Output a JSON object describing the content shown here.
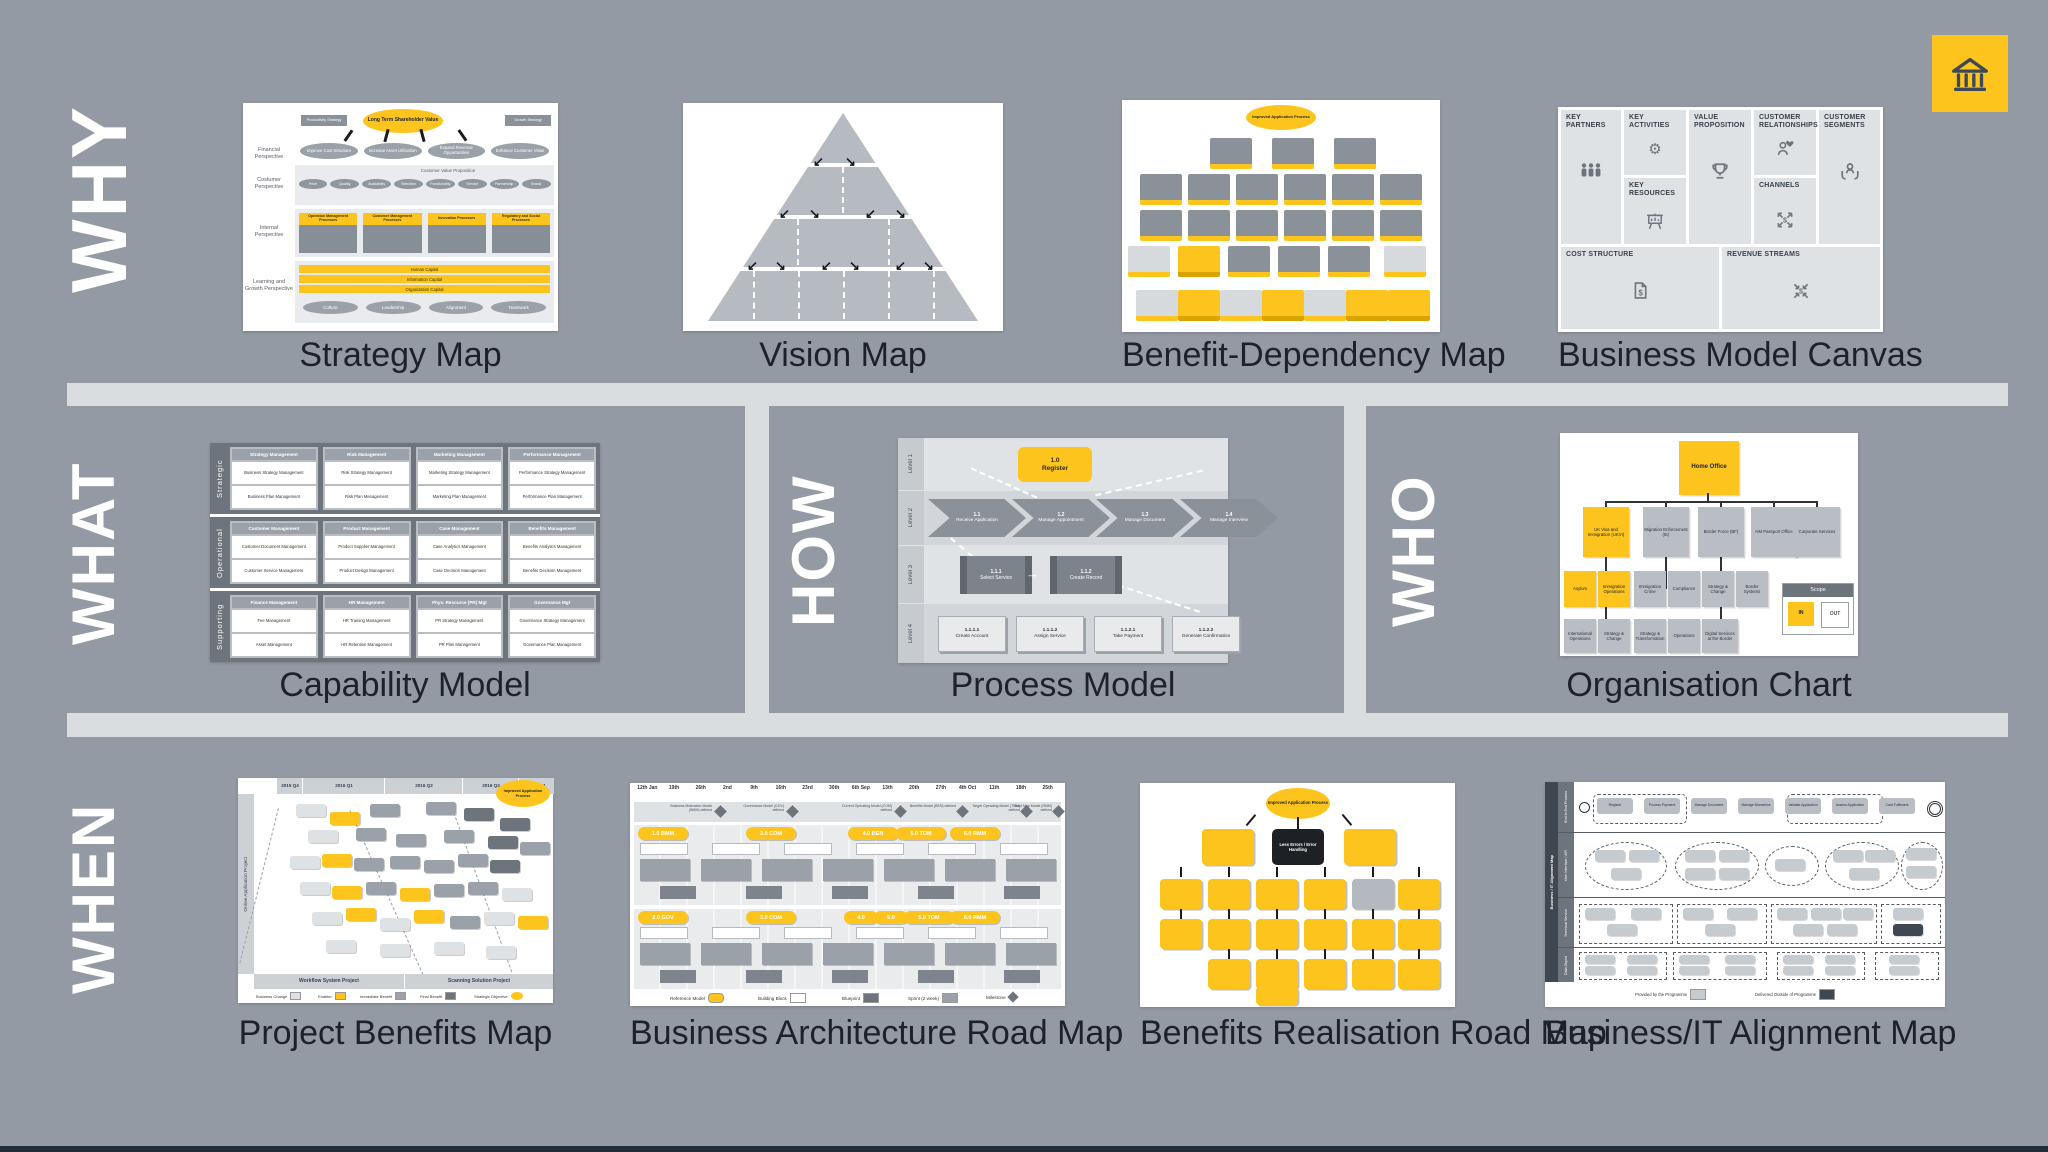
{
  "colors": {
    "background": "#939aa3",
    "divider": "#d9dde0",
    "accent_yellow": "#fcc41d",
    "ink": "#20242c",
    "panel_dark": "#6d747c",
    "footer_navy": "#232c3a"
  },
  "brand": {
    "icon": "bank-icon"
  },
  "why": {
    "label": "WHY",
    "strategy_map": {
      "title": "Strategy Map",
      "objective": "Long Term Shareholder Value",
      "left_tag": "Productivity Strategy",
      "right_tag": "Growth Strategy",
      "perspectives": [
        "Financial Perspective",
        "Costumer Perspective",
        "Internal Perspective",
        "Learning and Growth Perspective"
      ],
      "financial_goals": [
        "Improve Cost Structure",
        "Increase Asset Utilisation",
        "Expand Revenue Opportunities",
        "Enhance Costumer Value"
      ],
      "customer_value_proposition": "Customer Value Proposition",
      "customer_attributes": [
        "Price",
        "Quality",
        "Availability",
        "Selection",
        "Functionality",
        "Service",
        "Partnership",
        "Brand"
      ],
      "internal_processes": [
        "Operation Management Processes",
        "Customer Management Processes",
        "Innovation Processes",
        "Regulatory and Social Processes"
      ],
      "capitals": [
        "Human Capital",
        "Information Capital",
        "Organization Capital"
      ],
      "learning_values": [
        "Culture",
        "Leadership",
        "Alignment",
        "Teamwork"
      ]
    },
    "vision_map": {
      "title": "Vision Map"
    },
    "benefit_dependency_map": {
      "title": "Benefit-Dependency Map",
      "objective": "Improved Application Process"
    },
    "business_model_canvas": {
      "title": "Business Model Canvas",
      "key_partners": "KEY PARTNERS",
      "key_activities": "KEY ACTIVITIES",
      "value_proposition": "VALUE PROPOSITION",
      "customer_relationships": "CUSTOMER RELATIONSHIPS",
      "customer_segments": "CUSTOMER SEGMENTS",
      "key_resources": "KEY RESOURCES",
      "channels": "CHANNELS",
      "cost_structure": "COST STRUCTURE",
      "revenue_streams": "REVENUE STREAMS"
    }
  },
  "what": {
    "label": "WHAT",
    "capability_model": {
      "title": "Capability Model",
      "rows": [
        {
          "label": "Strategic",
          "groups": [
            {
              "name": "Strategy Management",
              "a": "Business Strategy Management",
              "b": "Business Plan Management"
            },
            {
              "name": "Risk Management",
              "a": "Risk Strategy Management",
              "b": "Risk Plan Management"
            },
            {
              "name": "Marketing Management",
              "a": "Marketing Strategy Management",
              "b": "Marketing Plan Management"
            },
            {
              "name": "Performance Management",
              "a": "Performance Strategy Management",
              "b": "Performance Plan Management"
            }
          ]
        },
        {
          "label": "Operational",
          "groups": [
            {
              "name": "Customer Management",
              "a": "Customer Document Management",
              "b": "Customer Service Management"
            },
            {
              "name": "Product Management",
              "a": "Product Supplier Management",
              "b": "Product Design Management"
            },
            {
              "name": "Case Management",
              "a": "Case Analytics Management",
              "b": "Case Decision Management"
            },
            {
              "name": "Benefits Management",
              "a": "Benefits Analytics Management",
              "b": "Benefits Decision Management"
            }
          ]
        },
        {
          "label": "Supporting",
          "groups": [
            {
              "name": "Finance Management",
              "a": "Fee Management",
              "b": "Asset Management"
            },
            {
              "name": "HR Management",
              "a": "HR Training Management",
              "b": "HR Retention Management"
            },
            {
              "name": "Phys. Resource (PR) Mgt",
              "a": "PR Strategy Management",
              "b": "PR Plan Management"
            },
            {
              "name": "Governance Mgt",
              "a": "Governance Strategy Management",
              "b": "Governance Plan Management"
            }
          ]
        }
      ]
    }
  },
  "how": {
    "label": "HOW",
    "process_model": {
      "title": "Process Model",
      "levels": [
        "Level 1",
        "Level 2",
        "Level 3",
        "Level 4"
      ],
      "l1": {
        "id": "1.0",
        "name": "Register"
      },
      "l2": [
        {
          "id": "1.1",
          "name": "Receive Application"
        },
        {
          "id": "1.2",
          "name": "Manage Appointment"
        },
        {
          "id": "1.3",
          "name": "Manage Document"
        },
        {
          "id": "1.4",
          "name": "Manage Interview"
        }
      ],
      "l3": [
        {
          "id": "1.1.1",
          "name": "Select Service"
        },
        {
          "id": "1.1.2",
          "name": "Create Record"
        }
      ],
      "l4": [
        {
          "id": "1.1.1.1",
          "name": "Create Account"
        },
        {
          "id": "1.1.1.2",
          "name": "Assign Service"
        },
        {
          "id": "1.1.2.1",
          "name": "Take Payment"
        },
        {
          "id": "1.1.2.2",
          "name": "Generate Confirmation"
        }
      ]
    }
  },
  "who": {
    "label": "WHO",
    "organisation_chart": {
      "title": "Organisation Chart",
      "root": "Home Office",
      "level2": [
        "UK Visa and Immigration (UKVI)",
        "Migration Enforcement (IE)",
        "Border Force (BF)",
        "HM Passport Office",
        "Corporate Services"
      ],
      "level3": [
        "Asylum",
        "Immigration Operations",
        "Immigration Crime",
        "Compliance",
        "Strategy & Change",
        "Border Systems"
      ],
      "level4": [
        "International Operations",
        "Strategy & Change",
        "Strategy & Transformation",
        "Operations",
        "Digital Services at the Border"
      ],
      "scope": {
        "label": "Scope",
        "in": "IN",
        "out": "OUT"
      }
    }
  },
  "when": {
    "label": "WHEN",
    "project_benefits_map": {
      "title": "Project Benefits Map",
      "objective": "Improved Application Process",
      "timeline": [
        "2015 Q4",
        "2016 Q1",
        "2016 Q2",
        "2016 Q3",
        "2016 Q4"
      ],
      "left_axis": "Online Application Project",
      "bottom_axis": [
        "Workflow System Project",
        "Scanning Solution Project"
      ],
      "legend": [
        "Business Change",
        "Enabler",
        "Immediate Benefit",
        "Final Benefit",
        "Strategic Objective"
      ]
    },
    "business_architecture_road_map": {
      "title": "Business Architecture Road Map",
      "dates": [
        "12th Jan",
        "19th",
        "26th",
        "2nd",
        "9th",
        "16th",
        "23rd",
        "30th",
        "6th Sep",
        "13th",
        "20th",
        "27th",
        "4th Oct",
        "11th",
        "18th",
        "25th"
      ],
      "milestones": [
        "Business Motivation Model (BMM) defined",
        "Governance Model (GOV) defined",
        "Current Operating Model (COM) defined",
        "Benefits Model (BEN) defined",
        "Target Operating Model (TOM) defined",
        "Road Map Model (RMM) defined"
      ],
      "stream1_refs": [
        "1.0 BMM",
        "3.0 COM",
        "4.0 BEN",
        "5.0 TOM",
        "6.0 RMM"
      ],
      "stream2_refs": [
        "2.0 GOV",
        "3.0 COM",
        "4.0",
        "5.0",
        "5.0 TOM",
        "6.0 RMM"
      ],
      "legend": [
        "Reference Model",
        "Building Block",
        "Blueprint",
        "Sprint (2 week)",
        "Milestone"
      ]
    },
    "benefits_realisation_road_map": {
      "title": "Benefits Realisation Road Map",
      "objective": "Improved Application Process",
      "highlight": "Less Errors / Error Handling"
    },
    "business_it_alignment_map": {
      "title": "Business/IT Alignment Map",
      "side_label": "Business / IT Alignment Map",
      "lanes": [
        "End to End Process",
        "User Interface / API",
        "Technical Service",
        "Data Object"
      ],
      "flow": [
        "Register",
        "Process Payment",
        "Manage Document",
        "Manage Biometrics",
        "Validate Application",
        "Assess Application",
        "Card Fulfilment"
      ],
      "legend": [
        "Provided by the Programme",
        "Delivered Outside of Programme"
      ]
    }
  }
}
